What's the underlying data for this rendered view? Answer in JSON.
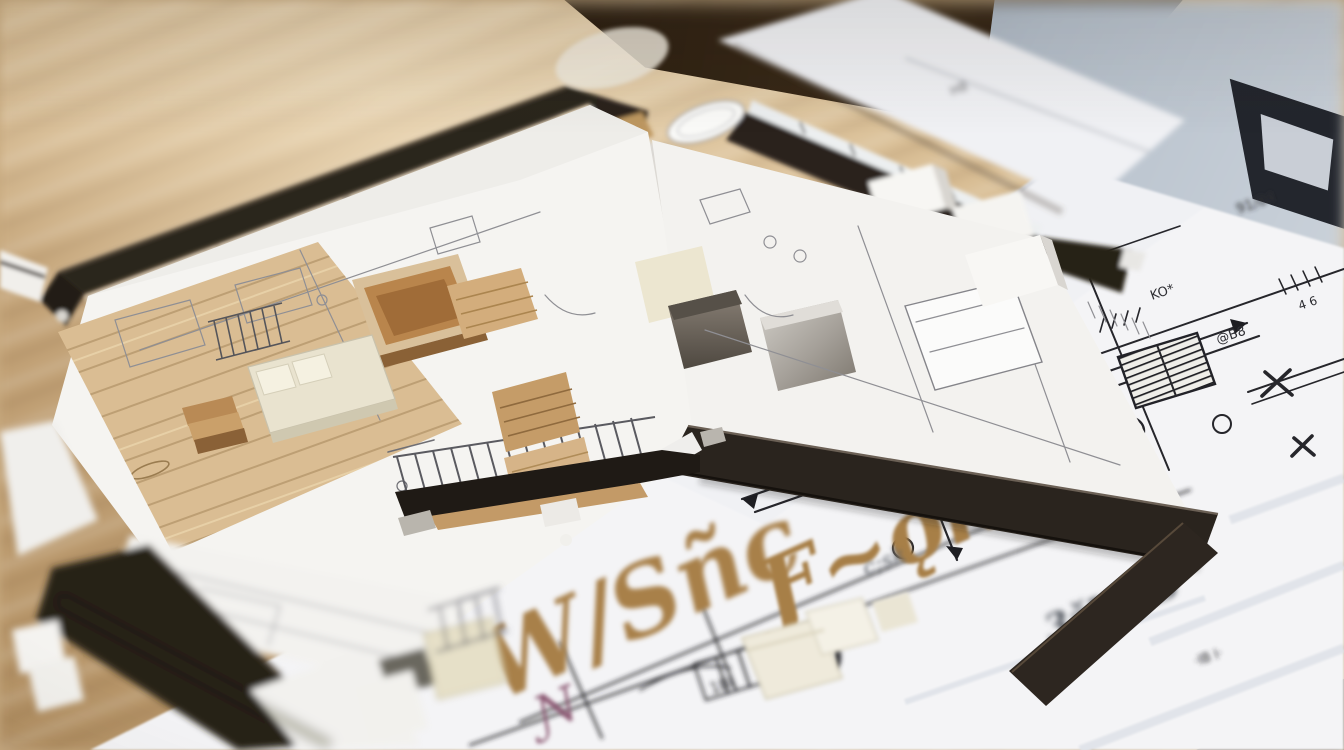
{
  "scene": {
    "subject": "Architectural scale model of an apartment standing on a technical floor-plan blueprint",
    "setting": "wooden desk with shallow depth of field"
  },
  "palette": {
    "table_wood": "#c9ab80",
    "paper": "#f4f4f6",
    "model_wall_dark": "#2b241d",
    "furniture_wood": "#b5834e",
    "furniture_cream": "#e9e3cf",
    "ink": "#26262b",
    "gold_ink": "#a8804a",
    "slate_surface": "#9fabba"
  },
  "blueprint": {
    "lettering": [
      {
        "text": "W/Sñc",
        "color": "#a8804a"
      },
      {
        "text": "Ƒ~ǭk",
        "color": "#a77f46"
      },
      {
        "text": "gdu",
        "color": "#ab8148"
      },
      {
        "text": "Ɲ",
        "color": "#8a5671"
      },
      {
        "text": "c;sk",
        "color": "#5a5f66"
      },
      {
        "text": "3ǯU!ᵒB",
        "color": "#565b63"
      }
    ],
    "annotations": [
      {
        "text": "N/O"
      },
      {
        "text": "ANTE|"
      },
      {
        "text": "4U)"
      },
      {
        "text": "£fTO"
      },
      {
        "text": "MU-"
      },
      {
        "text": "al."
      },
      {
        "text": "KO*"
      },
      {
        "text": "@B8"
      },
      {
        "text": "4 6"
      },
      {
        "text": "91/84"
      },
      {
        "text": "H8"
      },
      {
        "text": "1BI"
      },
      {
        "text": "0"
      },
      {
        "text": "9"
      },
      {
        "text": "Ja]"
      },
      {
        "text": "·IB I·"
      }
    ]
  }
}
